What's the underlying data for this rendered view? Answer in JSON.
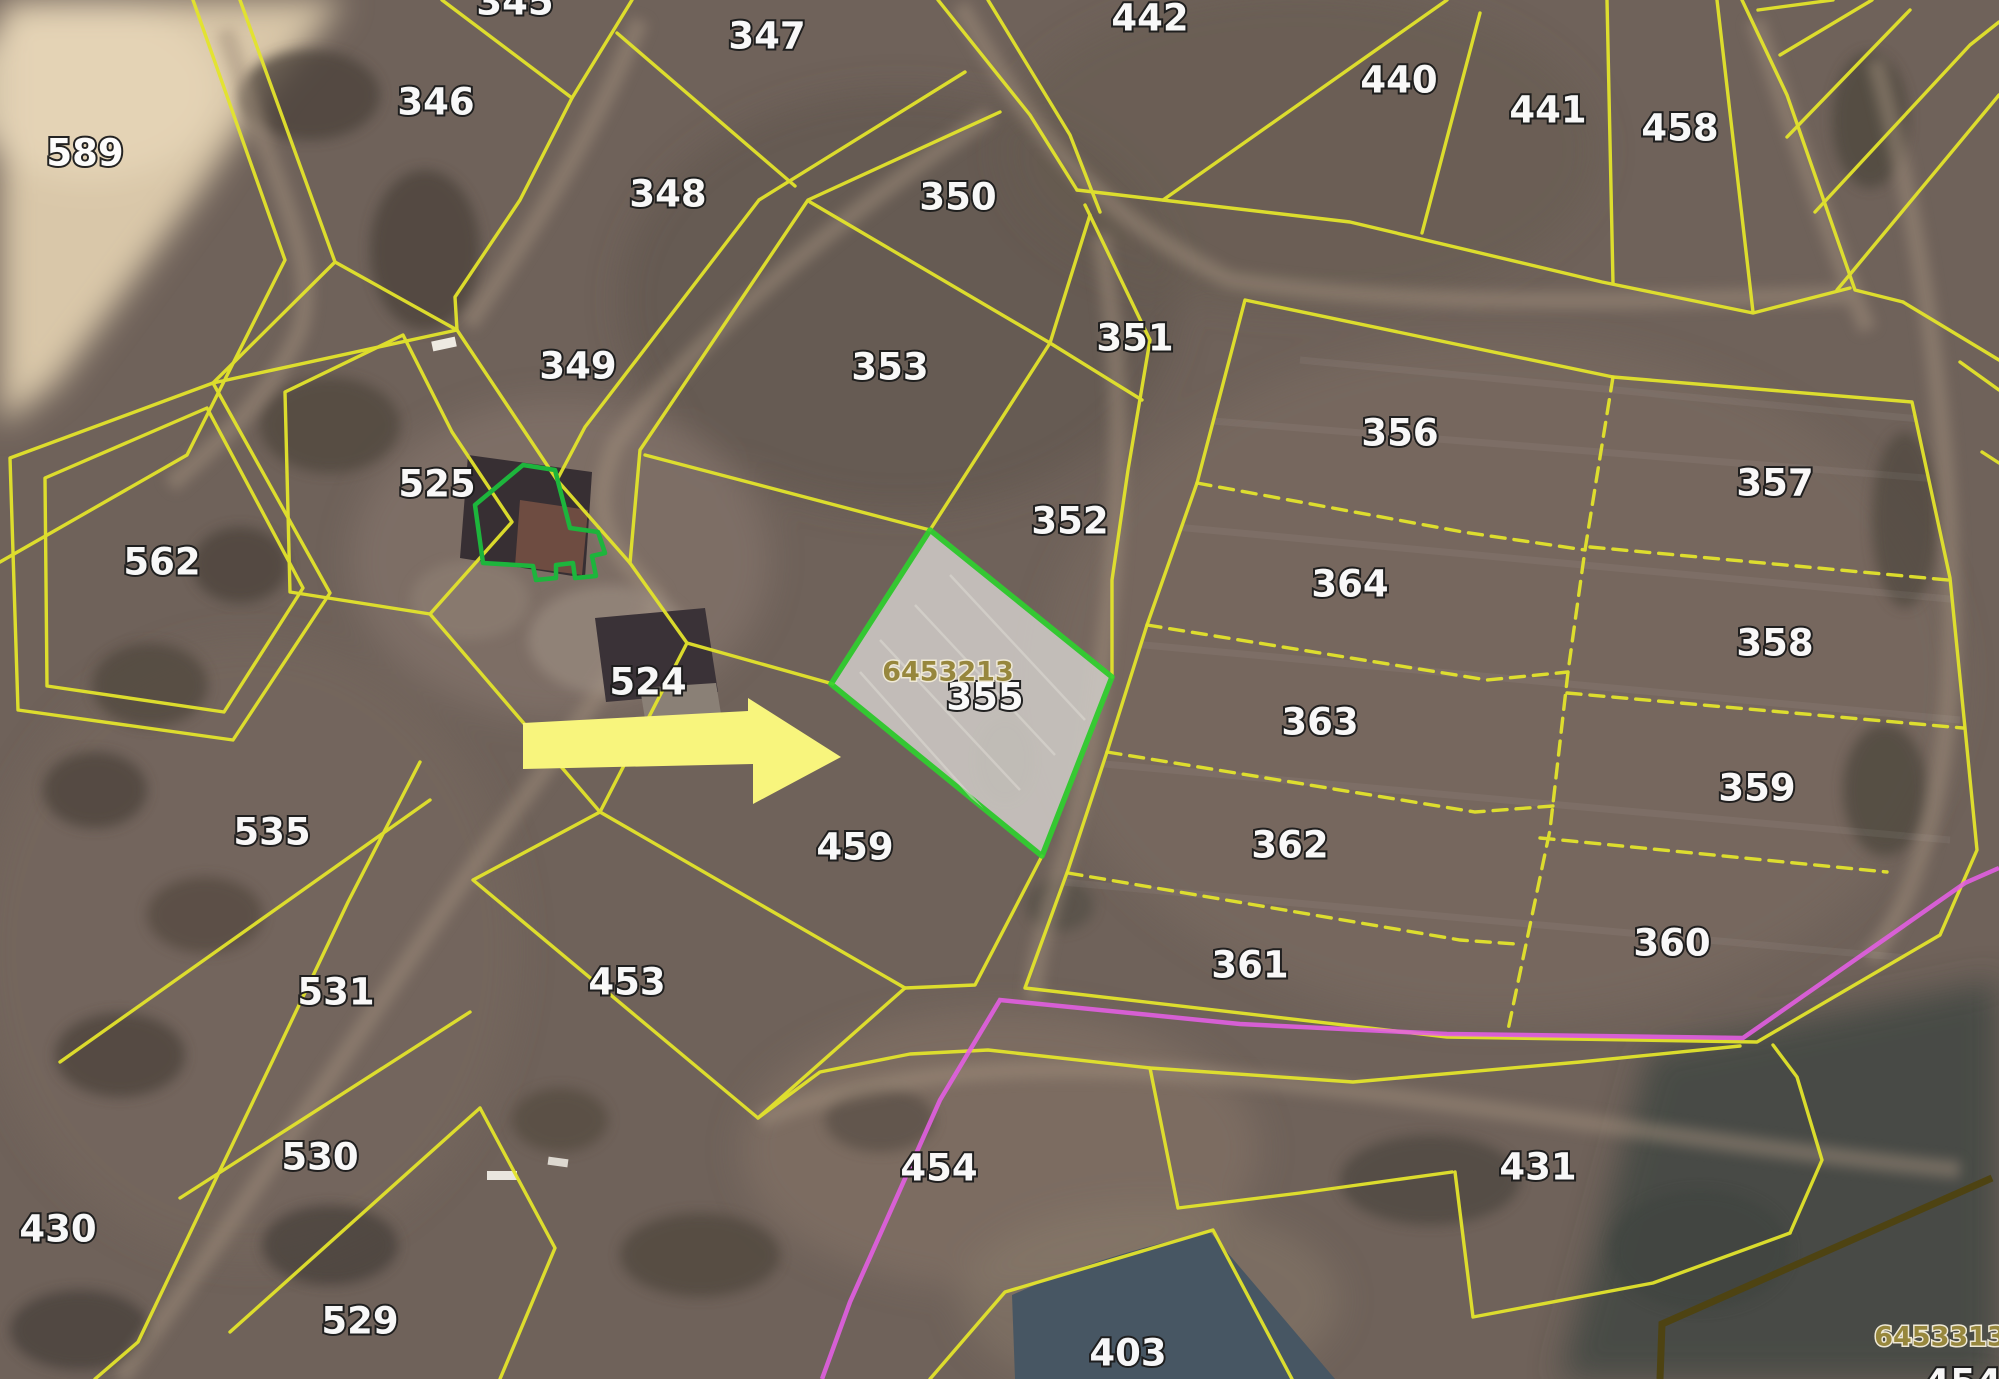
{
  "map": {
    "title": "cadastral-parcel-map",
    "selected_parcel": {
      "id": "355",
      "code": "6453213"
    },
    "corner_code": "6453313",
    "parcel_labels": [
      {
        "id": "589",
        "x": 85,
        "y": 153
      },
      {
        "id": "346",
        "x": 436,
        "y": 102
      },
      {
        "id": "347",
        "x": 767,
        "y": 36
      },
      {
        "id": "348",
        "x": 668,
        "y": 194
      },
      {
        "id": "350",
        "x": 958,
        "y": 197
      },
      {
        "id": "442",
        "x": 1150,
        "y": 18
      },
      {
        "id": "440",
        "x": 1399,
        "y": 80
      },
      {
        "id": "441",
        "x": 1548,
        "y": 110
      },
      {
        "id": "458",
        "x": 1680,
        "y": 128
      },
      {
        "id": "349",
        "x": 578,
        "y": 366
      },
      {
        "id": "353",
        "x": 890,
        "y": 367
      },
      {
        "id": "351",
        "x": 1135,
        "y": 338
      },
      {
        "id": "356",
        "x": 1400,
        "y": 433
      },
      {
        "id": "357",
        "x": 1775,
        "y": 483
      },
      {
        "id": "352",
        "x": 1070,
        "y": 521
      },
      {
        "id": "364",
        "x": 1350,
        "y": 584
      },
      {
        "id": "525",
        "x": 437,
        "y": 484
      },
      {
        "id": "562",
        "x": 162,
        "y": 562
      },
      {
        "id": "358",
        "x": 1775,
        "y": 643
      },
      {
        "id": "363",
        "x": 1320,
        "y": 722
      },
      {
        "id": "524",
        "x": 648,
        "y": 682
      },
      {
        "id": "355",
        "x": 985,
        "y": 697
      },
      {
        "id": "359",
        "x": 1757,
        "y": 788
      },
      {
        "id": "362",
        "x": 1290,
        "y": 845
      },
      {
        "id": "459",
        "x": 855,
        "y": 847
      },
      {
        "id": "535",
        "x": 272,
        "y": 832
      },
      {
        "id": "360",
        "x": 1672,
        "y": 943
      },
      {
        "id": "361",
        "x": 1250,
        "y": 965
      },
      {
        "id": "531",
        "x": 336,
        "y": 992
      },
      {
        "id": "453",
        "x": 627,
        "y": 982
      },
      {
        "id": "530",
        "x": 320,
        "y": 1157
      },
      {
        "id": "430",
        "x": 58,
        "y": 1229
      },
      {
        "id": "529",
        "x": 360,
        "y": 1321
      },
      {
        "id": "454",
        "x": 939,
        "y": 1168
      },
      {
        "id": "431",
        "x": 1538,
        "y": 1167
      },
      {
        "id": "403",
        "x": 1128,
        "y": 1353
      }
    ],
    "partial_labels": [
      {
        "id": "345",
        "x": 515,
        "y": 2
      },
      {
        "id": "454",
        "x": 1963,
        "y": 1383
      }
    ],
    "code_labels": [
      {
        "text": "6453213",
        "x": 948,
        "y": 672
      },
      {
        "text": "6453313",
        "x": 1940,
        "y": 1337
      }
    ],
    "colors": {
      "parcel_line": "#e3e42c",
      "selected_border": "#2ed32e",
      "selected_fill": "#cbc7c2",
      "building_outline": "#1db53c",
      "route_line": "#e55fe5",
      "district_line": "#4e4312",
      "label_fill": "#fdfdfd",
      "code_fill": "#97873d",
      "arrow_fill": "#f8f57d",
      "water_fill": "#475663"
    }
  }
}
